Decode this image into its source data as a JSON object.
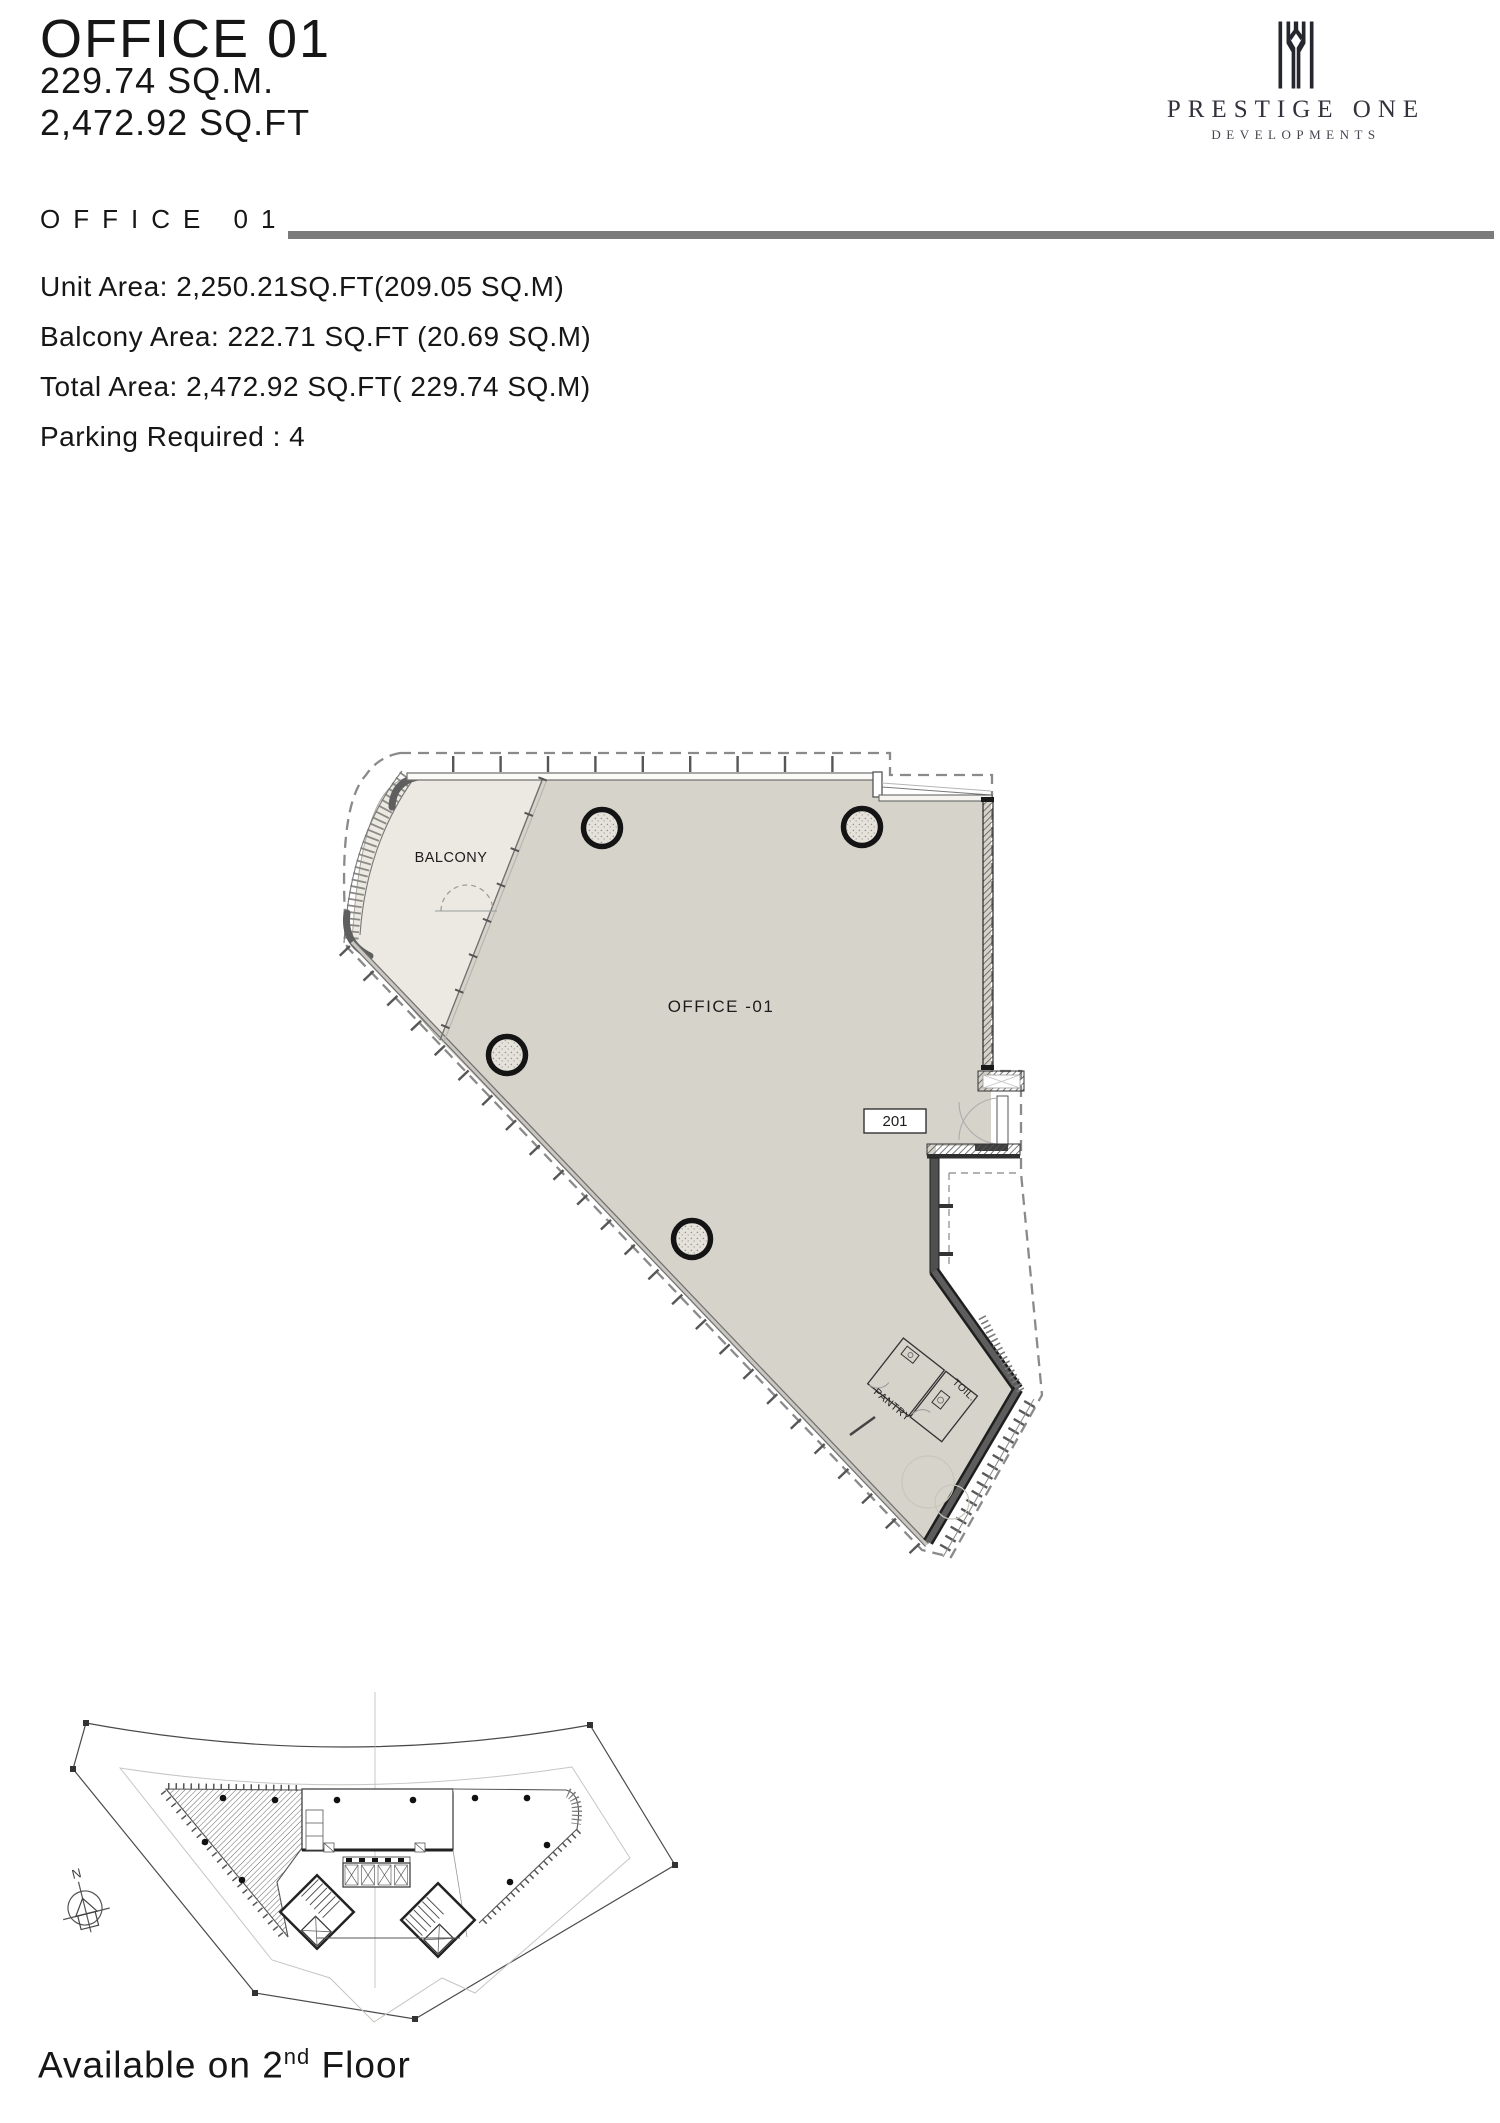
{
  "header": {
    "title": "OFFICE 01",
    "area_sqm": "229.74 SQ.M.",
    "area_sqft": "2,472.92 SQ.FT"
  },
  "logo": {
    "brand": "PRESTIGE ONE",
    "subtitle": "DEVELOPMENTS",
    "mark_icon": "prestige-one-building-mark",
    "color": "#26262e"
  },
  "details": {
    "section_title": "OFFICE 01",
    "rule_color": "#7b7b7b",
    "lines": [
      "Unit Area: 2,250.21SQ.FT(209.05 SQ.M)",
      "Balcony Area: 222.71 SQ.FT (20.69 SQ.M)",
      "Total Area: 2,472.92 SQ.FT( 229.74 SQ.M)",
      "Parking Required : 4"
    ]
  },
  "floor_plan": {
    "labels": {
      "balcony": "BALCONY",
      "office": "OFFICE -01",
      "unit_number": "201",
      "pantry": "PANTRY",
      "toilet": "TOIL."
    },
    "colors": {
      "office_fill": "#d6d3cb",
      "balcony_fill": "#ebe9e2",
      "wall_dark": "#4f4f4f",
      "line_gray": "#6e6e6e",
      "dashed_gray": "#8a8a8a"
    }
  },
  "site_plan": {
    "north_label": "N",
    "availability": {
      "prefix": "Available on 2",
      "superscript": "nd",
      "suffix": " Floor"
    }
  }
}
